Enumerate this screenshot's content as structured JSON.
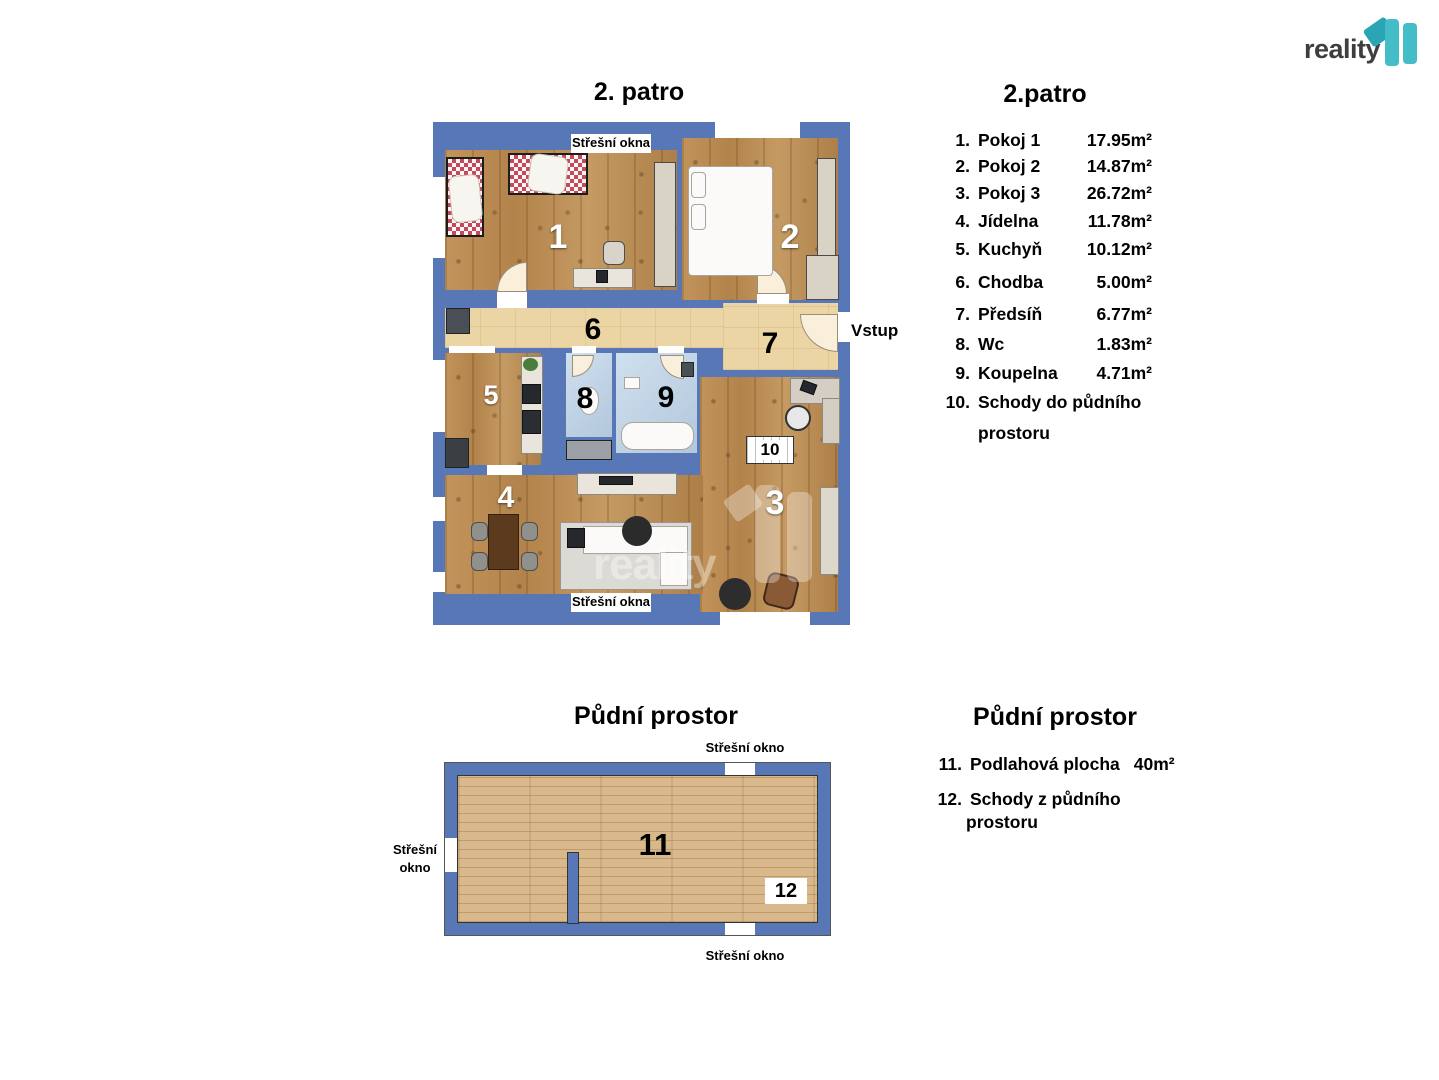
{
  "logo": {
    "text": "reality"
  },
  "watermark": {
    "text": "reality"
  },
  "colors": {
    "wall_blue": "#5877b6",
    "room_wood": "#b78a51",
    "attic_wood": "#d9b98c",
    "corridor_beige": "#ecd5a4",
    "bath_blue": "#bdd4e9",
    "logo_teal": "#45bdc9",
    "logo_teal_dark": "#2ba4b5"
  },
  "floor2": {
    "plan_title": "2. patro",
    "legend_title": "2.patro",
    "vstup_label": "Vstup",
    "skylight_top": "Střešní okna",
    "skylight_bottom": "Střešní okna",
    "room_labels": {
      "r1": "1",
      "r2": "2",
      "r3": "3",
      "r4": "4",
      "r5": "5",
      "r6": "6",
      "r7": "7",
      "r8": "8",
      "r9": "9",
      "r10": "10"
    },
    "legend": [
      {
        "num": "1.",
        "name": "Pokoj 1",
        "area": "17.95m²"
      },
      {
        "num": "2.",
        "name": "Pokoj 2",
        "area": "14.87m²"
      },
      {
        "num": "3.",
        "name": "Pokoj 3",
        "area": "26.72m²"
      },
      {
        "num": "4.",
        "name": "Jídelna",
        "area": "11.78m²"
      },
      {
        "num": "5.",
        "name": "Kuchyň",
        "area": "10.12m²"
      },
      {
        "num": "6.",
        "name": "Chodba",
        "area": "5.00m²"
      },
      {
        "num": "7.",
        "name": "Předsíň",
        "area": "6.77m²"
      },
      {
        "num": "8.",
        "name": "Wc",
        "area": "1.83m²"
      },
      {
        "num": "9.",
        "name": "Koupelna",
        "area": "4.71m²"
      },
      {
        "num": "10.",
        "name": "Schody do půdního",
        "area": "",
        "name2": "prostoru"
      }
    ]
  },
  "attic": {
    "plan_title": "Půdní prostor",
    "legend_title": "Půdní prostor",
    "skylight_top": "Střešní okno",
    "skylight_bottom": "Střešní okno",
    "skylight_left_line1": "Střešní",
    "skylight_left_line2": "okno",
    "room_labels": {
      "r11": "11",
      "r12": "12"
    },
    "legend": [
      {
        "num": "11.",
        "name": "Podlahová plocha",
        "area": "40m²"
      },
      {
        "num": "12.",
        "name": "Schody z půdního",
        "area": "",
        "name2": "prostoru"
      }
    ]
  }
}
